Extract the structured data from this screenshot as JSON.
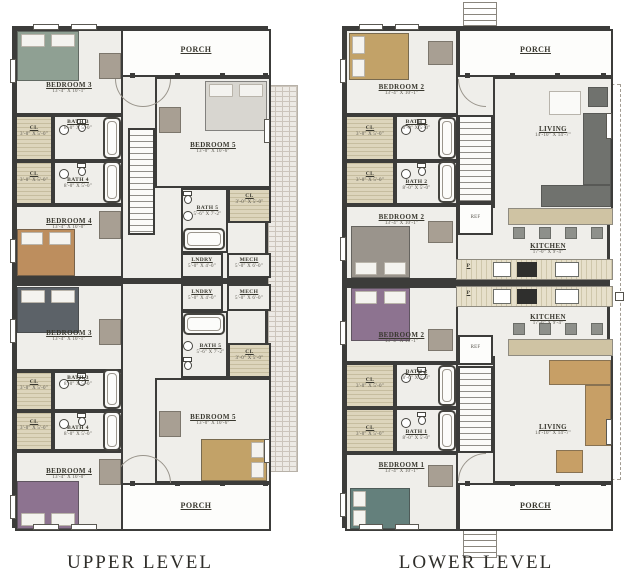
{
  "titles": {
    "upper": "UPPER LEVEL",
    "lower": "LOWER LEVEL"
  },
  "rooms": {
    "porch": {
      "name": "PORCH"
    },
    "bedroom1": {
      "name": "BEDROOM 1",
      "dims": "13'-4\" X 10'-1\""
    },
    "bedroom2": {
      "name": "BEDROOM 2",
      "dims": "13'-4\" X 10'-1\""
    },
    "bedroom3": {
      "name": "BEDROOM 3",
      "dims": "13'-4\" X 10'-1\""
    },
    "bedroom4": {
      "name": "BEDROOM 4",
      "dims": "13'-4\" X 10'-0\""
    },
    "bedroom5": {
      "name": "BEDROOM 5",
      "dims": "13'-0\" X 10'-6\""
    },
    "bath1": {
      "name": "BATH 1",
      "dims": "8'-0\" X 5'-0\""
    },
    "bath2": {
      "name": "BATH 2",
      "dims": "8'-0\" X 5'-0\""
    },
    "bath3": {
      "name": "BATH 3",
      "dims": "8'-0\" X 5'-0\""
    },
    "bath4": {
      "name": "BATH 4",
      "dims": "8'-0\" X 5'-0\""
    },
    "bath5": {
      "name": "BATH 5",
      "dims": "5'-6\" X 7'-2\""
    },
    "closet": {
      "name": "CL",
      "dims": "3'-0\" X 5'-0\""
    },
    "laundry": {
      "name": "LNDRY",
      "dims": "5'-0\" X 4'-0\""
    },
    "mech": {
      "name": "MECH",
      "dims": "5'-0\" X 6'-0\""
    },
    "kitchen": {
      "name": "KITCHEN",
      "dims": "17'-0\" X 9'-4\""
    },
    "living": {
      "name": "LIVING",
      "dims": "14'-10\" X 14'-7\""
    },
    "pantry": {
      "name": "P"
    },
    "ref": {
      "name": "REF"
    }
  },
  "colors": {
    "wall": "#3c3c3a",
    "floor": "#efeeea",
    "closet_hatch": "#d9d1b8",
    "bed_sage": "#8fa093",
    "bed_brown": "#bd8e5e",
    "bed_slate": "#5c6268",
    "bed_plum": "#8d7390",
    "bed_tan": "#c2a268",
    "bed_teal": "#64807c",
    "bed_light": "#d8d6d0",
    "sofa_gray": "#70726e",
    "sofa_tan": "#c79f66",
    "furniture_gray": "#a89f93"
  }
}
